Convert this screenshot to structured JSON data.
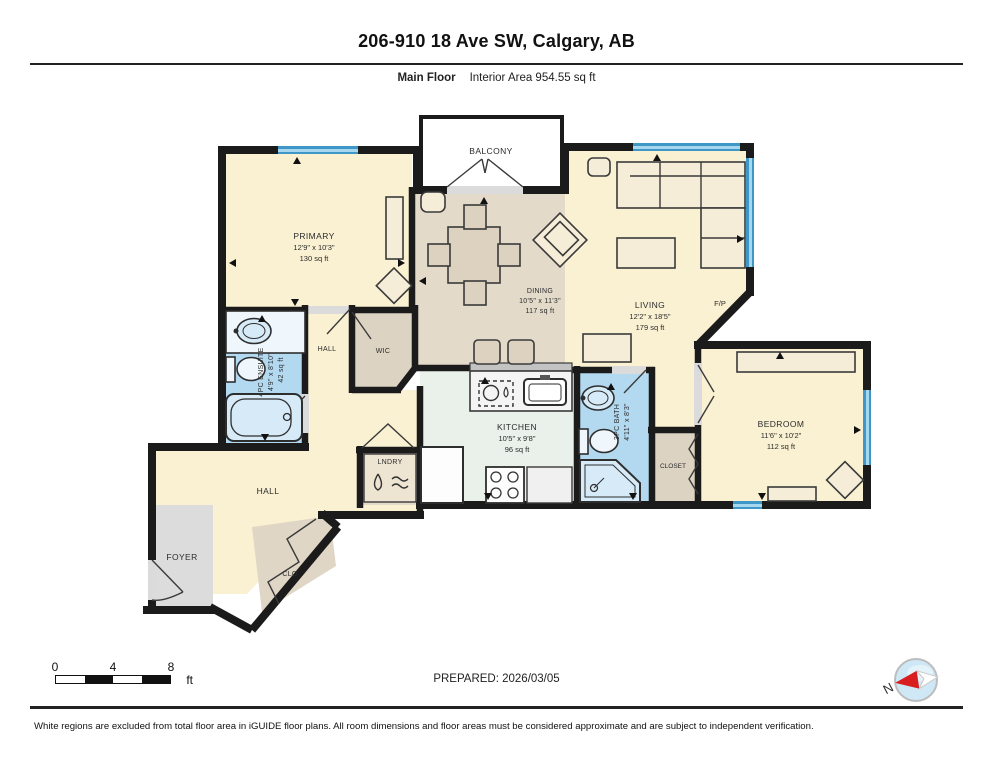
{
  "header": {
    "title": "206-910 18 Ave SW, Calgary, AB",
    "floor_label": "Main Floor",
    "area_label": "Interior Area 954.55 sq ft"
  },
  "rooms": {
    "balcony": {
      "name": "BALCONY"
    },
    "primary": {
      "name": "PRIMARY",
      "dims": "12'9\" x 10'3\"",
      "area": "130 sq ft"
    },
    "dining": {
      "name": "DINING",
      "dims": "10'5\" x 11'3\"",
      "area": "117 sq ft"
    },
    "living": {
      "name": "LIVING",
      "dims": "12'2\" x 18'5\"",
      "area": "179 sq ft"
    },
    "fireplace": {
      "name": "F/P"
    },
    "ensuite": {
      "name": "4PC ENSUITE",
      "dims": "4'9\" x 8'10\"",
      "area": "42 sq ft"
    },
    "hall_upper": {
      "name": "HALL"
    },
    "wic": {
      "name": "WIC"
    },
    "kitchen": {
      "name": "KITCHEN",
      "dims": "10'5\" x 9'8\"",
      "area": "96 sq ft"
    },
    "bath": {
      "name": "3PC BATH",
      "dims": "4'11\" x 8'3\""
    },
    "closet": {
      "name": "CLOSET"
    },
    "bedroom": {
      "name": "BEDROOM",
      "dims": "11'6\" x 10'2\"",
      "area": "112 sq ft"
    },
    "hall_lower": {
      "name": "HALL"
    },
    "foyer": {
      "name": "FOYER"
    },
    "clo": {
      "name": "CLO"
    },
    "laundry": {
      "name": "LNDRY"
    }
  },
  "scale_bar": {
    "t0": "0",
    "t4": "4",
    "t8": "8",
    "unit": "ft"
  },
  "compass": {
    "label": "N"
  },
  "footer": {
    "prepared": "PREPARED: 2026/03/05",
    "disclaimer": "White regions are excluded from total floor area in iGUIDE floor plans. All room dimensions and floor areas must be considered approximate and are subject to independent verification."
  },
  "colors": {
    "floor_cream": "#FAF1D3",
    "floor_tan": "#E3DACA",
    "floor_mint": "#E9F1EA",
    "floor_blue": "#B3D9F1",
    "floor_gray": "#DCDCDC",
    "floor_taupe": "#DCD3C3",
    "wall": "#1B1B1B",
    "window_blue": "#3E97C6",
    "compass_red": "#D81E1E"
  }
}
